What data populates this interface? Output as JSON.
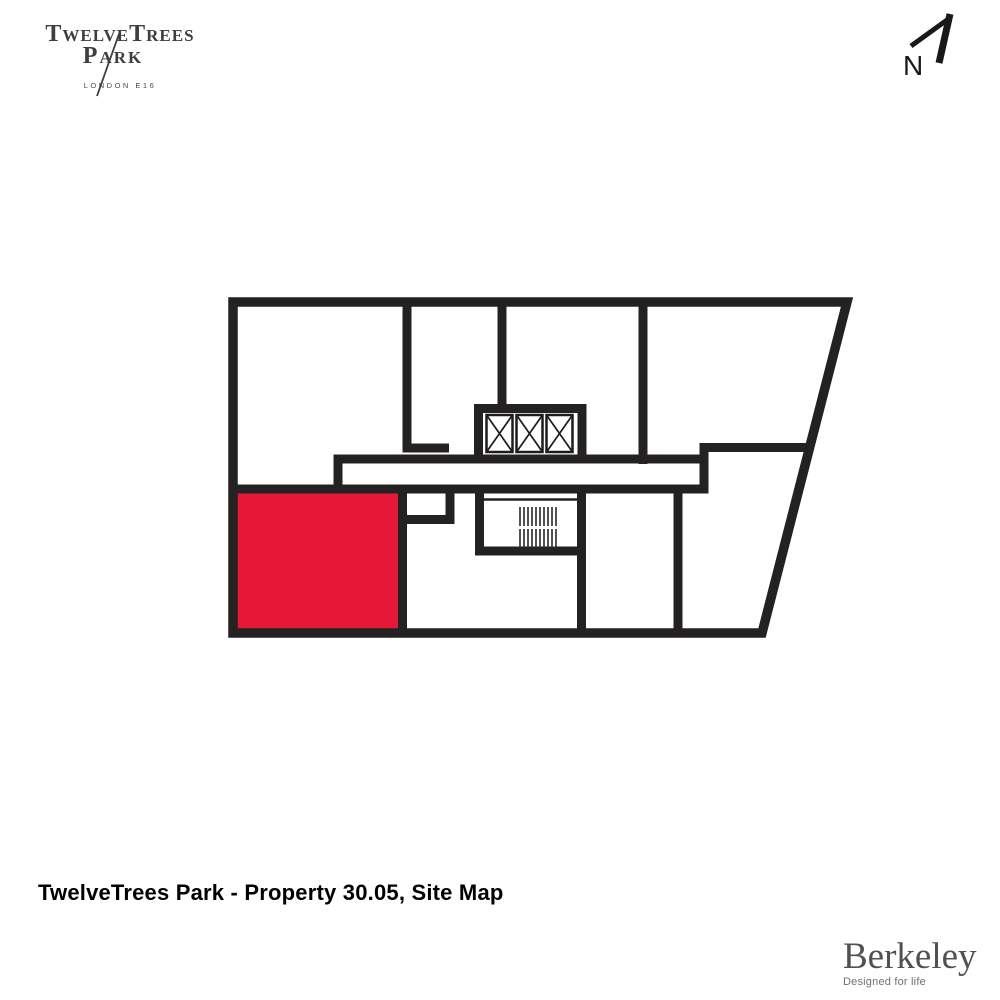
{
  "brand": {
    "name_caps": "TwelveTrees",
    "name_line2": "Park",
    "location": "LONDON E16"
  },
  "compass": {
    "label": "N"
  },
  "plan": {
    "highlighted_unit": "30.05",
    "highlight_color": "#e51937",
    "wall_color": "#242122",
    "lift_count": 3,
    "features": [
      "lift-bank",
      "stairs",
      "corridor"
    ]
  },
  "caption": {
    "text": "TwelveTrees Park - Property 30.05, Site Map"
  },
  "footer": {
    "developer": "Berkeley",
    "tagline": "Designed for life"
  }
}
